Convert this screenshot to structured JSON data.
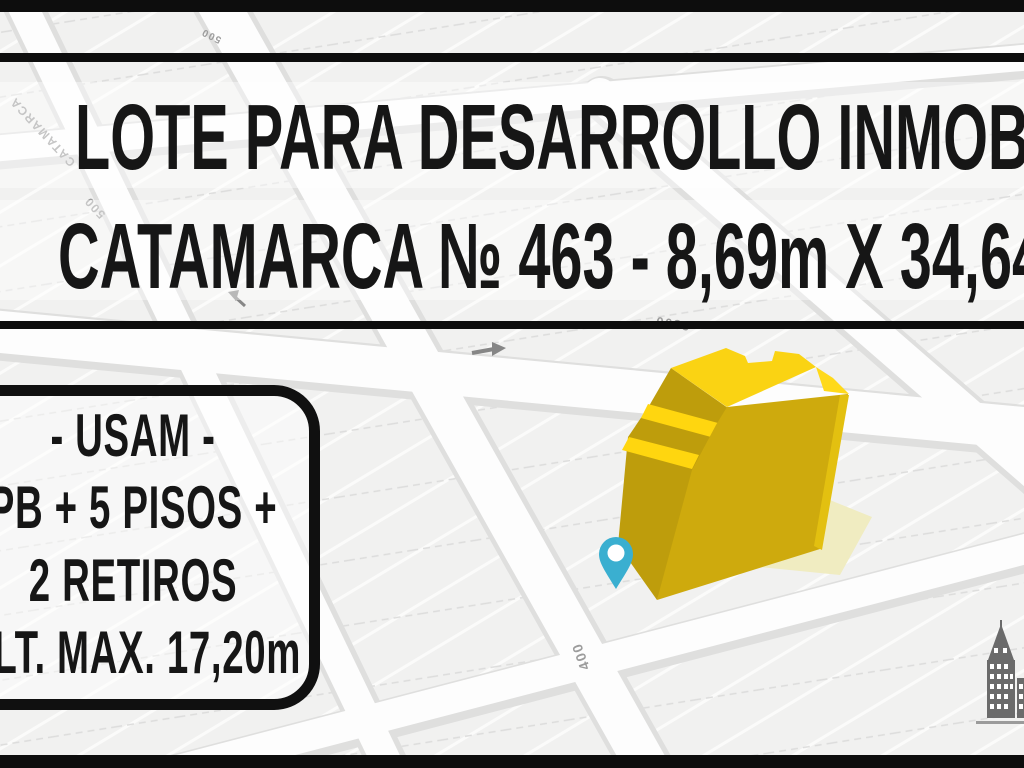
{
  "banner": {
    "title_line1": "LOTE PARA DESARROLLO INMOBILIARIO",
    "title_line2": "CATAMARCA № 463 - 8,69m X 34,64m"
  },
  "info_box": {
    "line1": "- USAM -",
    "line2": "PB + 5 PISOS +",
    "line3": "2 RETIROS",
    "line4": "ALT. MAX. 17,20m"
  },
  "map": {
    "street_labels": [
      {
        "text": "CATAMARCA"
      },
      {
        "text": "500"
      },
      {
        "text": "500"
      },
      {
        "text": "2800"
      },
      {
        "text": "400"
      }
    ]
  },
  "colors": {
    "frame_bar": "#0D0D0D",
    "title_text": "#161616",
    "map_background": "#F1F1F0",
    "street_white": "#FDFDFD",
    "street_edge": "#D9D9D8",
    "building_top_yellow": "#FAD313",
    "building_front_yellow": "#CEAA0D",
    "building_side_dark": "#BE9D0C",
    "building_side_light": "#E3C010",
    "lot_pale_yellow": "#F0ECC1",
    "pin_teal": "#3AAFD0",
    "logo_gray": "#6B6B6B"
  },
  "logo": {
    "icon": "city-building-icon"
  }
}
